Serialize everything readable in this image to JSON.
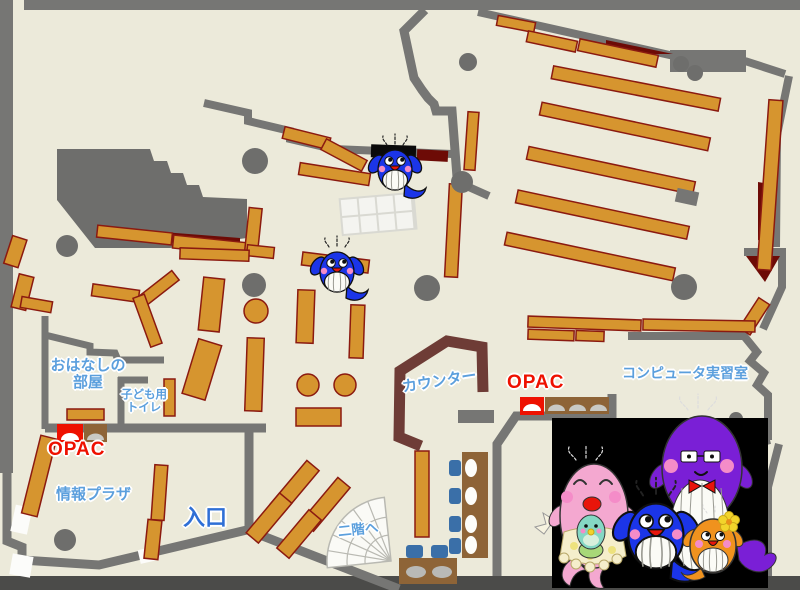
{
  "map": {
    "kind": "library-floor-map",
    "labels": {
      "storytelling_room_line1": "おはなしの",
      "storytelling_room_line2": "部屋",
      "kids_toilet_line1": "子ども用",
      "kids_toilet_line2": "トイレ",
      "opac_left": "OPAC",
      "info_plaza": "情報プラザ",
      "entrance": "入口",
      "to_second_floor": "二階へ",
      "counter": "カウンター",
      "opac_right": "OPAC",
      "computer_room": "コンピュータ実習室"
    },
    "colors": {
      "floor": "#ECEADA",
      "wall_gray": "#767674",
      "outer_band_dark": "#4B4B49",
      "block_gray": "#6E6E6C",
      "shelf_orange": "#D6952F",
      "shelf_border": "#8B1A10",
      "dark_red_area": "#6D0B06",
      "counter_brown": "#6E3C36",
      "table_brown": "#8E6437",
      "chair_blue": "#3A6FA8",
      "label_blue": "#5B9FDD",
      "entrance_blue": "#2F6FD6",
      "opac_red": "#EE1100",
      "photo_panel_black": "#000000",
      "mascot_blue": "#1B35E8",
      "mascot_purple": "#7A1FD6",
      "mascot_pink": "#F4A8D0",
      "mascot_teal": "#85D8C4",
      "mascot_orange": "#F0921E"
    },
    "mascots": {
      "small_blue_whales_on_map": 2,
      "family_photo_members": [
        "pink-mother-whale",
        "teal-baby-whale",
        "blue-boy-whale",
        "purple-father-whale",
        "orange-girl-whale"
      ]
    }
  }
}
